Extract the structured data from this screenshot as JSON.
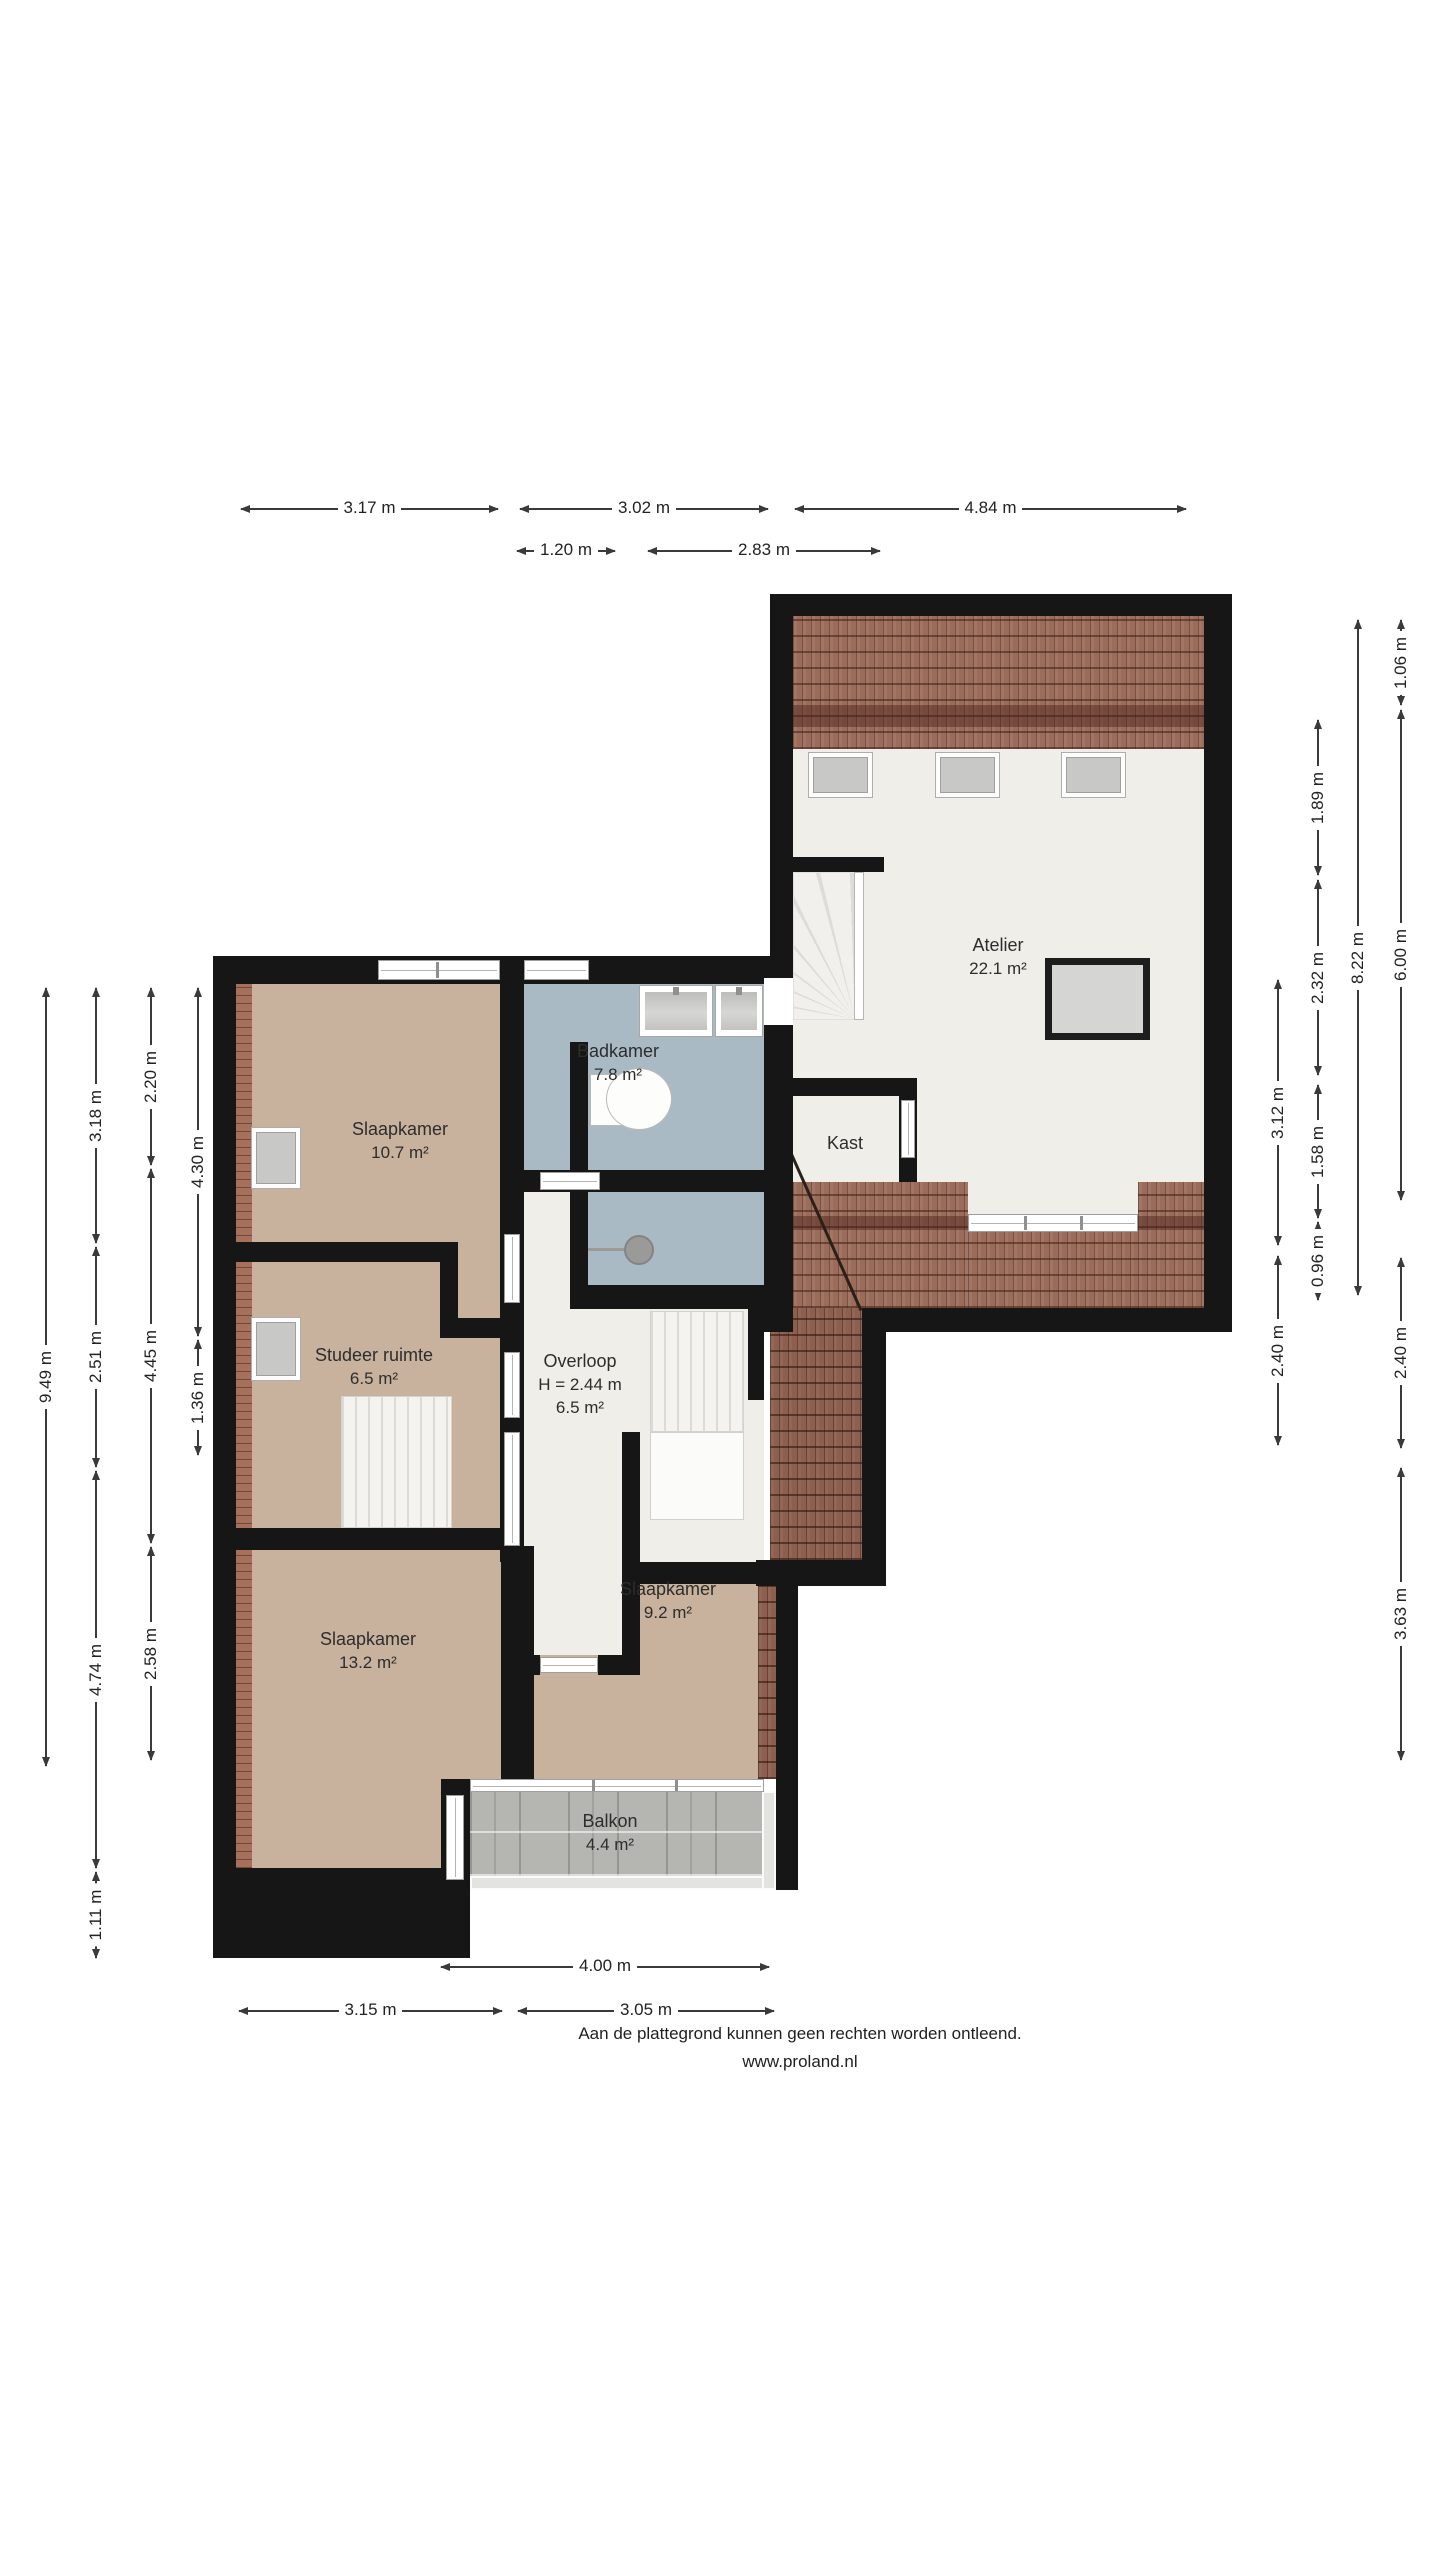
{
  "title": "Plattegrond verdieping",
  "rooms": [
    {
      "id": "atelier",
      "name": "Atelier",
      "area": "22.1 m²",
      "note": ""
    },
    {
      "id": "kast",
      "name": "Kast",
      "area": "",
      "note": ""
    },
    {
      "id": "badkamer",
      "name": "Badkamer",
      "area": "7.8 m²",
      "note": ""
    },
    {
      "id": "slaapkamer1",
      "name": "Slaapkamer",
      "area": "10.7 m²",
      "note": ""
    },
    {
      "id": "studeer",
      "name": "Studeer ruimte",
      "area": "6.5 m²",
      "note": ""
    },
    {
      "id": "overloop",
      "name": "Overloop",
      "area": "6.5 m²",
      "note": "H = 2.44 m"
    },
    {
      "id": "slaapkamer2",
      "name": "Slaapkamer",
      "area": "13.2 m²",
      "note": ""
    },
    {
      "id": "slaapkamer3",
      "name": "Slaapkamer",
      "area": "9.2 m²",
      "note": ""
    },
    {
      "id": "balkon",
      "name": "Balkon",
      "area": "4.4 m²",
      "note": ""
    }
  ],
  "dimensions": {
    "top": [
      "3.17 m",
      "3.02 m",
      "4.84 m",
      "1.20 m",
      "2.83 m"
    ],
    "bottom": [
      "4.00 m",
      "3.15 m",
      "3.05 m"
    ],
    "left": [
      "9.49 m",
      "3.18 m",
      "2.51 m",
      "4.74 m",
      "1.11 m",
      "2.20 m",
      "4.45 m",
      "2.58 m",
      "4.30 m",
      "1.36 m"
    ],
    "right": [
      "3.12 m",
      "2.40 m",
      "1.89 m",
      "2.32 m",
      "1.58 m",
      "0.96 m",
      "8.22 m",
      "1.06 m",
      "6.00 m",
      "2.40 m",
      "3.63 m"
    ]
  },
  "footer": {
    "line1": "Aan de plattegrond kunnen geen rechten worden ontleend.",
    "line2": "www.proland.nl"
  },
  "colors": {
    "wall": "#161616",
    "floor_bedroom": "#c8b29e",
    "floor_bathroom": "#a9bac5",
    "floor_hall": "#f0eee8",
    "roof_tiles": "#9b6c5a",
    "balcony_pavers": "#b5b5b1"
  }
}
